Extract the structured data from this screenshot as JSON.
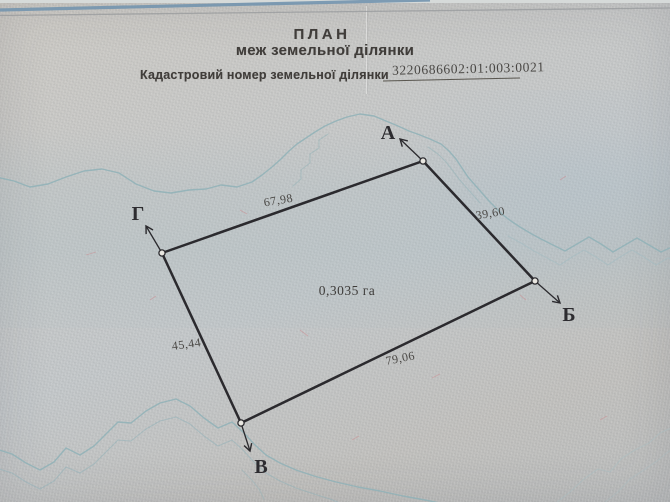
{
  "document": {
    "title": "ПЛАН",
    "subtitle": "меж земельної ділянки",
    "cadastral_label": "Кадастровий номер земельної ділянки",
    "cadastral_number": "3220686602:01:003:0021"
  },
  "plot": {
    "area": "0,3035 га",
    "vertices": [
      {
        "name": "А"
      },
      {
        "name": "Б"
      },
      {
        "name": "В"
      },
      {
        "name": "Г"
      }
    ],
    "sides": [
      {
        "edge": "Г-А",
        "length": "67,98"
      },
      {
        "edge": "А-Б",
        "length": "39,60"
      },
      {
        "edge": "В-Б",
        "length": "79,06"
      },
      {
        "edge": "Г-В",
        "length": "45,44"
      }
    ]
  },
  "colors": {
    "ink": "#2b2a2e",
    "paper": "#c6c5c2",
    "contour": "#8fb1b7",
    "top_stripe": "#7495af"
  }
}
